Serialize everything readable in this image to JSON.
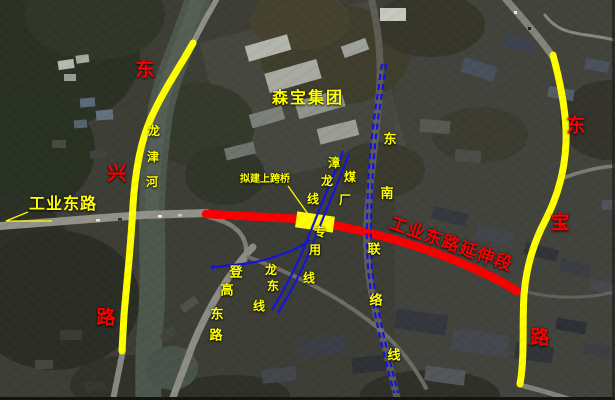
{
  "map": {
    "type": "satellite-annotation-map",
    "description_visible_text_only": true
  },
  "labels": {
    "company": "森宝集团",
    "road_existing": "工业东路",
    "road_extension": "工业东路延伸段",
    "bridge_note": "拟建上跨桥",
    "river_chars": [
      "龙",
      "津",
      "河"
    ],
    "road_dongxing_chars": [
      "东",
      "兴",
      "路"
    ],
    "road_dongbao_chars": [
      "东",
      "宝",
      "路"
    ],
    "road_denggao_chars": [
      "登",
      "高",
      "东",
      "路"
    ],
    "rail_zhanglong_chars": [
      "漳",
      "龙",
      "线"
    ],
    "rail_coal_spur_chars": [
      "煤",
      "厂",
      "专",
      "用",
      "线"
    ],
    "rail_longdong_chars": [
      "龙",
      "东",
      "线"
    ],
    "rail_southeast_link_chars": [
      "东",
      "南",
      "联",
      "络",
      "线"
    ]
  },
  "legend_colors": {
    "highlighted_road_yellow": "#ffff00",
    "planned_road_red": "#fb0000",
    "railway_blue": "#1414dd",
    "label_yellow": "#ffff00",
    "label_red": "#fb0000"
  }
}
